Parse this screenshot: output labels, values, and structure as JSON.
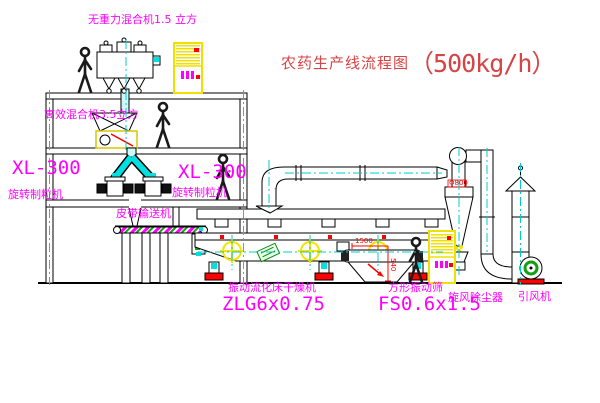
{
  "title": {
    "name": "农药生产线流程图",
    "capacity": "（500kg/h）"
  },
  "equipment": {
    "gravity_free_mixer": "无重力混合机1.5 立方",
    "mixer_3_5": "高效混合机3.5立方",
    "granulator_left_model": "XL-300",
    "granulator_left_name": "旋转制粒机",
    "granulator_right_model": "XL-300",
    "granulator_right_name": "旋转制粒机",
    "belt_conveyor": "皮带输送机",
    "fluid_bed_dryer_name": "振动流化床干燥机",
    "fluid_bed_dryer_model": "ZLG6x0.75",
    "square_sieve_name": "方形振动筛",
    "square_sieve_model": "FS0.6x1.5",
    "cyclone_name": "旋风除尘器",
    "fan_name": "引风机"
  },
  "dimensions": {
    "cyclone_dia": "Φ800",
    "sieve_len": "1500",
    "sieve_h": "540"
  },
  "colors": {
    "label_magenta": "#FF00FF",
    "title_red": "#D64545",
    "pipe_cyan": "#00E0E0",
    "cabinet_yellow": "#F0E000",
    "accent_red": "#FF0000",
    "accent_green": "#11A011",
    "vibrator_yellow": "#F5E400"
  }
}
